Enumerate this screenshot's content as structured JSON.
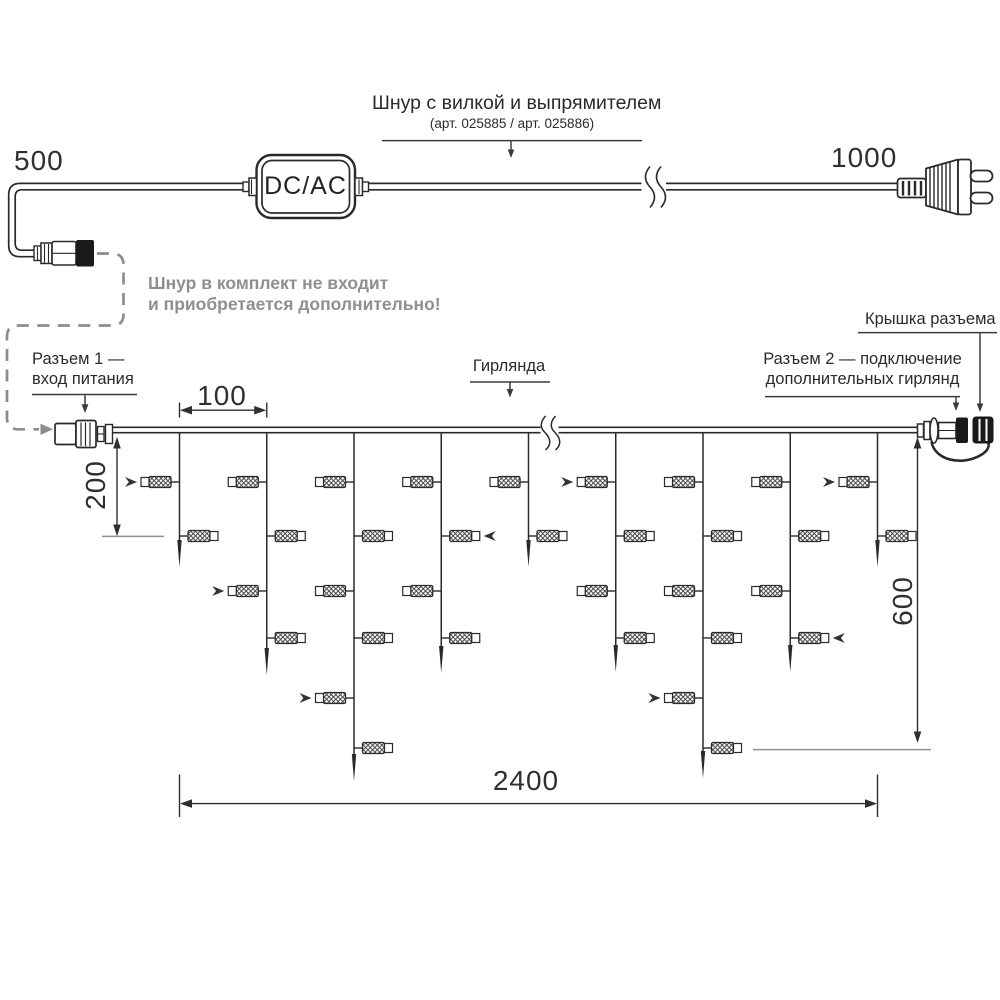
{
  "colors": {
    "line": "#2a2a2a",
    "gray": "#8c8c8c",
    "text": "#2b2b2b",
    "ref_line": "#8f8f8f"
  },
  "power_cord": {
    "title_line1": "Шнур с вилкой и выпрямителем",
    "title_line2": "(арт. 025885 / арт. 025886)",
    "length_left_label": "500",
    "length_right_label": "1000",
    "converter_label": "DC/AC",
    "note_line1": "Шнур в комплект не входит",
    "note_line2": "и приобретается дополнительно!"
  },
  "garland_labels": {
    "connector1_line1": "Разъем 1 —",
    "connector1_line2": "вход питания",
    "garland": "Гирлянда",
    "connector2_line1": "Разъем 2 — подключение",
    "connector2_line2": "дополнительных гирлянд",
    "cap": "Крышка разъема"
  },
  "dimensions": {
    "drop_spacing": "100",
    "first_drop_offset": "200",
    "drop_max_length": "600",
    "garland_length": "2400"
  },
  "garland": {
    "wire_y": 430,
    "bulb_rows_y": [
      482,
      536,
      591,
      638,
      698,
      748
    ],
    "drops": [
      {
        "x": 179.5,
        "tip_y": 567,
        "bulb_count": 2,
        "arrow_row": 1
      },
      {
        "x": 266.75,
        "tip_y": 675,
        "bulb_count": 4,
        "arrow_row": 3
      },
      {
        "x": 354,
        "tip_y": 781,
        "bulb_count": 6,
        "arrow_row": 5
      },
      {
        "x": 441.25,
        "tip_y": 673,
        "bulb_count": 4,
        "arrow_row": 2
      },
      {
        "x": 528.5,
        "tip_y": 567,
        "bulb_count": 2,
        "arrow_row": 0
      },
      {
        "x": 615.75,
        "tip_y": 672,
        "bulb_count": 4,
        "arrow_row": 1
      },
      {
        "x": 703,
        "tip_y": 778,
        "bulb_count": 6,
        "arrow_row": 5
      },
      {
        "x": 790.25,
        "tip_y": 672,
        "bulb_count": 4,
        "arrow_row": 4
      },
      {
        "x": 877.5,
        "tip_y": 567,
        "bulb_count": 2,
        "arrow_row": 1
      }
    ]
  }
}
